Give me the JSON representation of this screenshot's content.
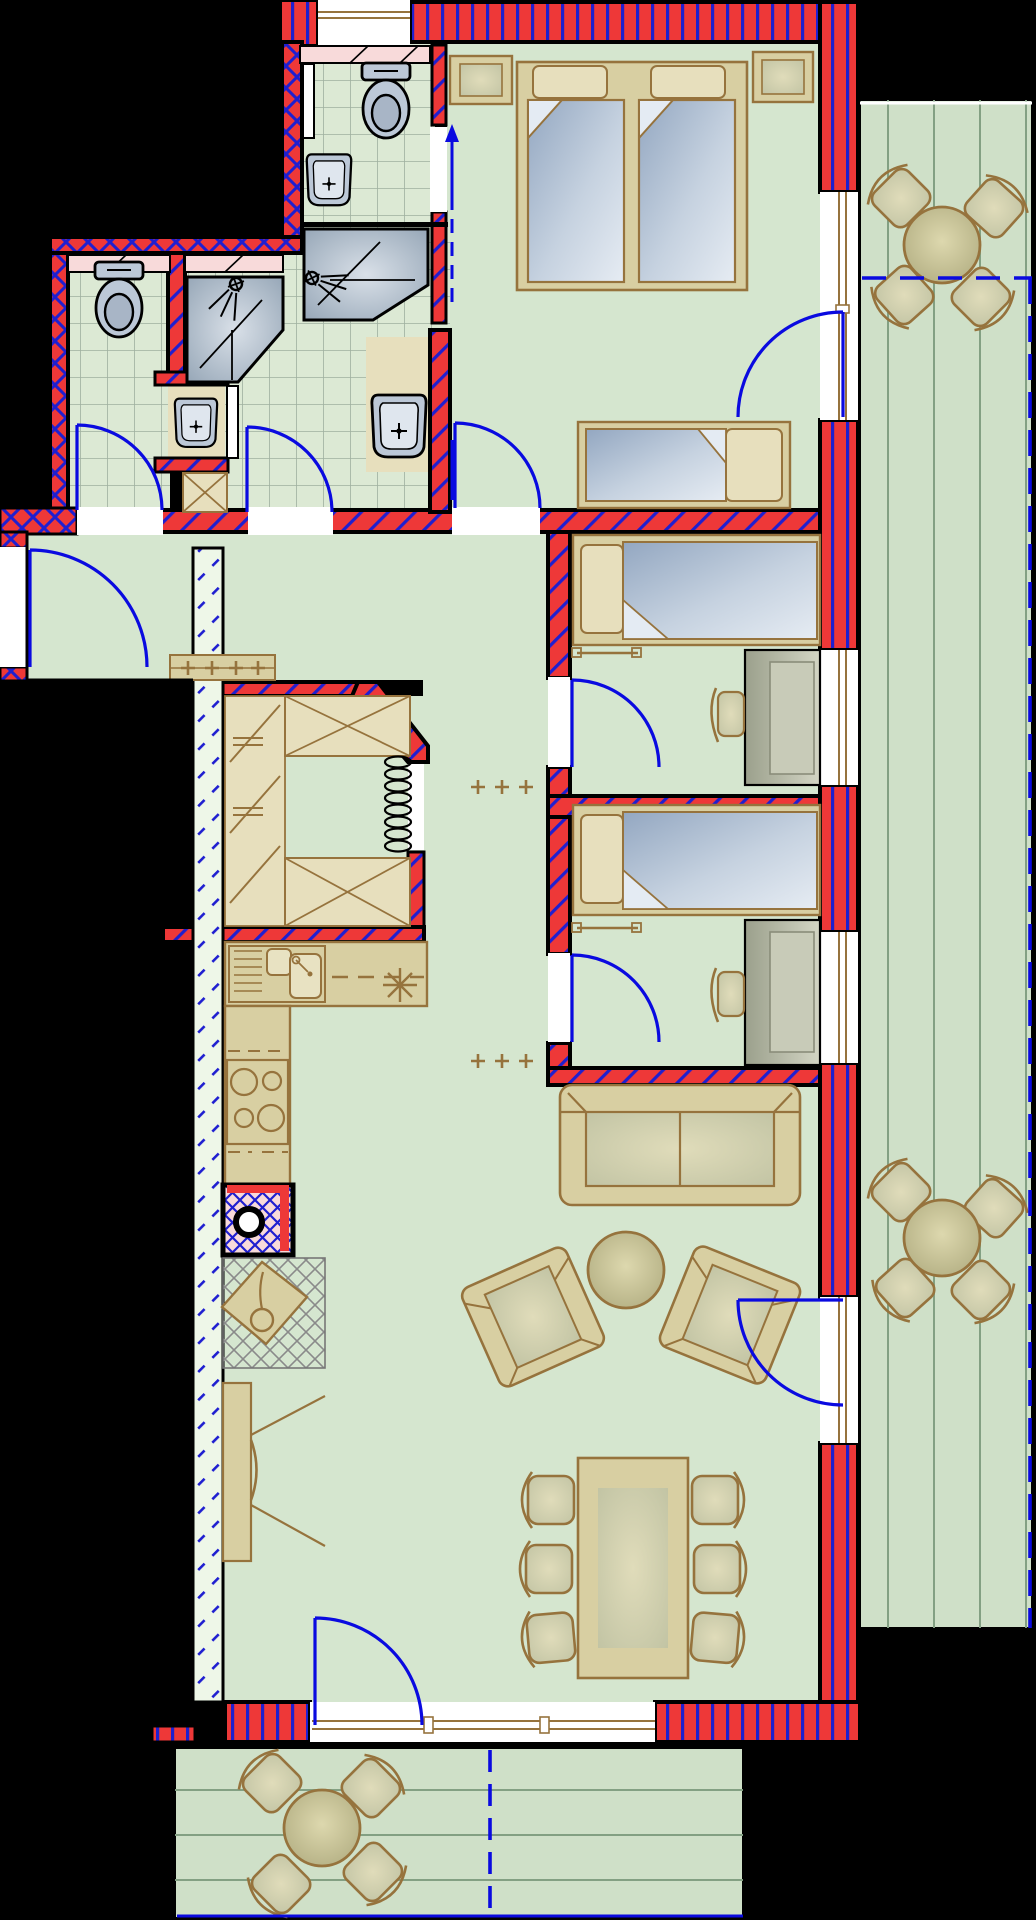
{
  "document": {
    "kind": "architectural-floor-plan",
    "visible_text": [],
    "colors": {
      "background": "#000000",
      "wall_fill": "#ee3838",
      "wall_hatch": "#1f1fd0",
      "insulated_wall": "#eef7e8",
      "floor": "#d5e6cf",
      "tile_floor": "#dce9d4",
      "deck_floor": "#cfe0c8",
      "furniture_tan": "#d8cfa2",
      "furniture_outline": "#96733d",
      "sanitary_fixture": "#bcc8d7",
      "door_swing": "#0a0ae0",
      "window_sill_pink": "#f8dada",
      "wardrobe_gray": "#b4b8a4"
    },
    "wall_hatch_styles": [
      "crosshatch-exterior",
      "diagonal-interior",
      "vertical-stripe-facade",
      "dashed-diagonal-insulation"
    ],
    "rooms": [
      {
        "name": "wc-ensuite-top",
        "fixtures": [
          "toilet",
          "washbasin",
          "wall-cabinet",
          "window",
          "pink-sill"
        ]
      },
      {
        "name": "wc-left",
        "fixtures": [
          "toilet",
          "pink-sill",
          "door"
        ]
      },
      {
        "name": "shower-bathroom-middle",
        "fixtures": [
          "corner-shower",
          "washbasin",
          "mirror-panel",
          "base-cabinet",
          "pink-sill",
          "door"
        ]
      },
      {
        "name": "shower-bathroom-right",
        "fixtures": [
          "walk-in-shower",
          "washbasin",
          "door"
        ]
      },
      {
        "name": "bedroom-master",
        "furniture": [
          "double-bed",
          "nightstand-left",
          "nightstand-right",
          "single-bed",
          "balcony-window-door"
        ]
      },
      {
        "name": "bedroom-2",
        "furniture": [
          "single-bed",
          "towel-rail",
          "wardrobe",
          "chair",
          "radiator-marks",
          "window",
          "door"
        ]
      },
      {
        "name": "bedroom-3",
        "furniture": [
          "single-bed",
          "towel-rail",
          "wardrobe",
          "chair",
          "radiator-marks",
          "window",
          "door"
        ]
      },
      {
        "name": "hallway",
        "furniture": [
          "entry-door",
          "radiator",
          "circulation-arrow"
        ]
      },
      {
        "name": "storage-closet",
        "furniture": [
          "wardrobe-rail-left",
          "shelf-unit-top",
          "shelf-unit-bottom",
          "clothes-rail-coil"
        ]
      },
      {
        "name": "kitchen",
        "furniture": [
          "double-sink-unit",
          "worktop",
          "dishwasher-asterisk",
          "stove-4-burners",
          "chimney-flue",
          "floor-mat",
          "stool"
        ]
      },
      {
        "name": "living-dining",
        "furniture": [
          "sofa",
          "coffee-table",
          "armchair-left",
          "armchair-right",
          "tv-board",
          "dining-table",
          "dining-chairs-x6",
          "terrace-door",
          "balcony-door",
          "window-band"
        ]
      },
      {
        "name": "balcony-right",
        "furniture": [
          "round-table-top",
          "chairs-x4-top",
          "round-table-bottom",
          "chairs-x4-bottom",
          "plank-deck",
          "dashed-divider"
        ]
      },
      {
        "name": "terrace-bottom",
        "furniture": [
          "round-table",
          "chairs-x4",
          "plank-deck",
          "dashed-divider"
        ]
      }
    ],
    "counts": {
      "doors_swing_arcs": 9,
      "windows": 7,
      "round_tables": 3,
      "outdoor_chairs": 12,
      "dining_chairs": 6,
      "beds": 4,
      "toilets": 2,
      "washbasins": 4,
      "showers": 3
    }
  }
}
